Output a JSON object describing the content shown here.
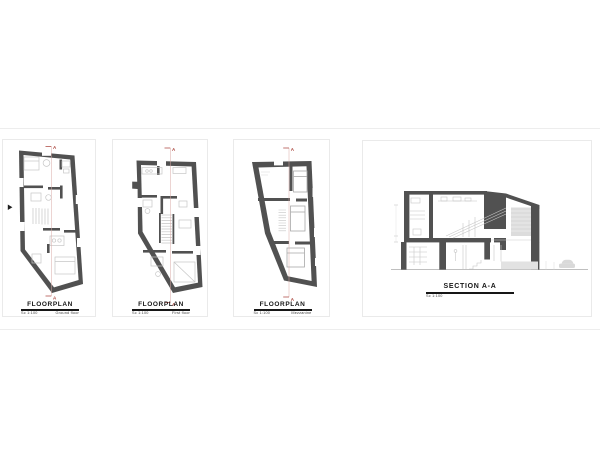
{
  "sheet": {
    "panels": [
      {
        "title": "FLOORPLAN",
        "scale": "Sc 1:100",
        "floor": "Ground floor"
      },
      {
        "title": "FLOORPLAN",
        "scale": "Sc 1:100",
        "floor": "First floor"
      },
      {
        "title": "FLOORPLAN",
        "scale": "Sc 1:100",
        "floor": "Mezzanine"
      },
      {
        "title": "SECTION A-A",
        "scale": "Sc 1:100"
      }
    ],
    "section_marker": "A",
    "colors": {
      "wall": "#515151",
      "furniture": "#c6c6c6",
      "bed_outline": "#a8a8a8",
      "section_line": "#d9aaa6",
      "marker": "#ad4a42",
      "hatch": "#dcdcdc",
      "platform": "#e2e2e2",
      "car": "#d9d9d9",
      "ground": "#aaaaaa"
    }
  }
}
